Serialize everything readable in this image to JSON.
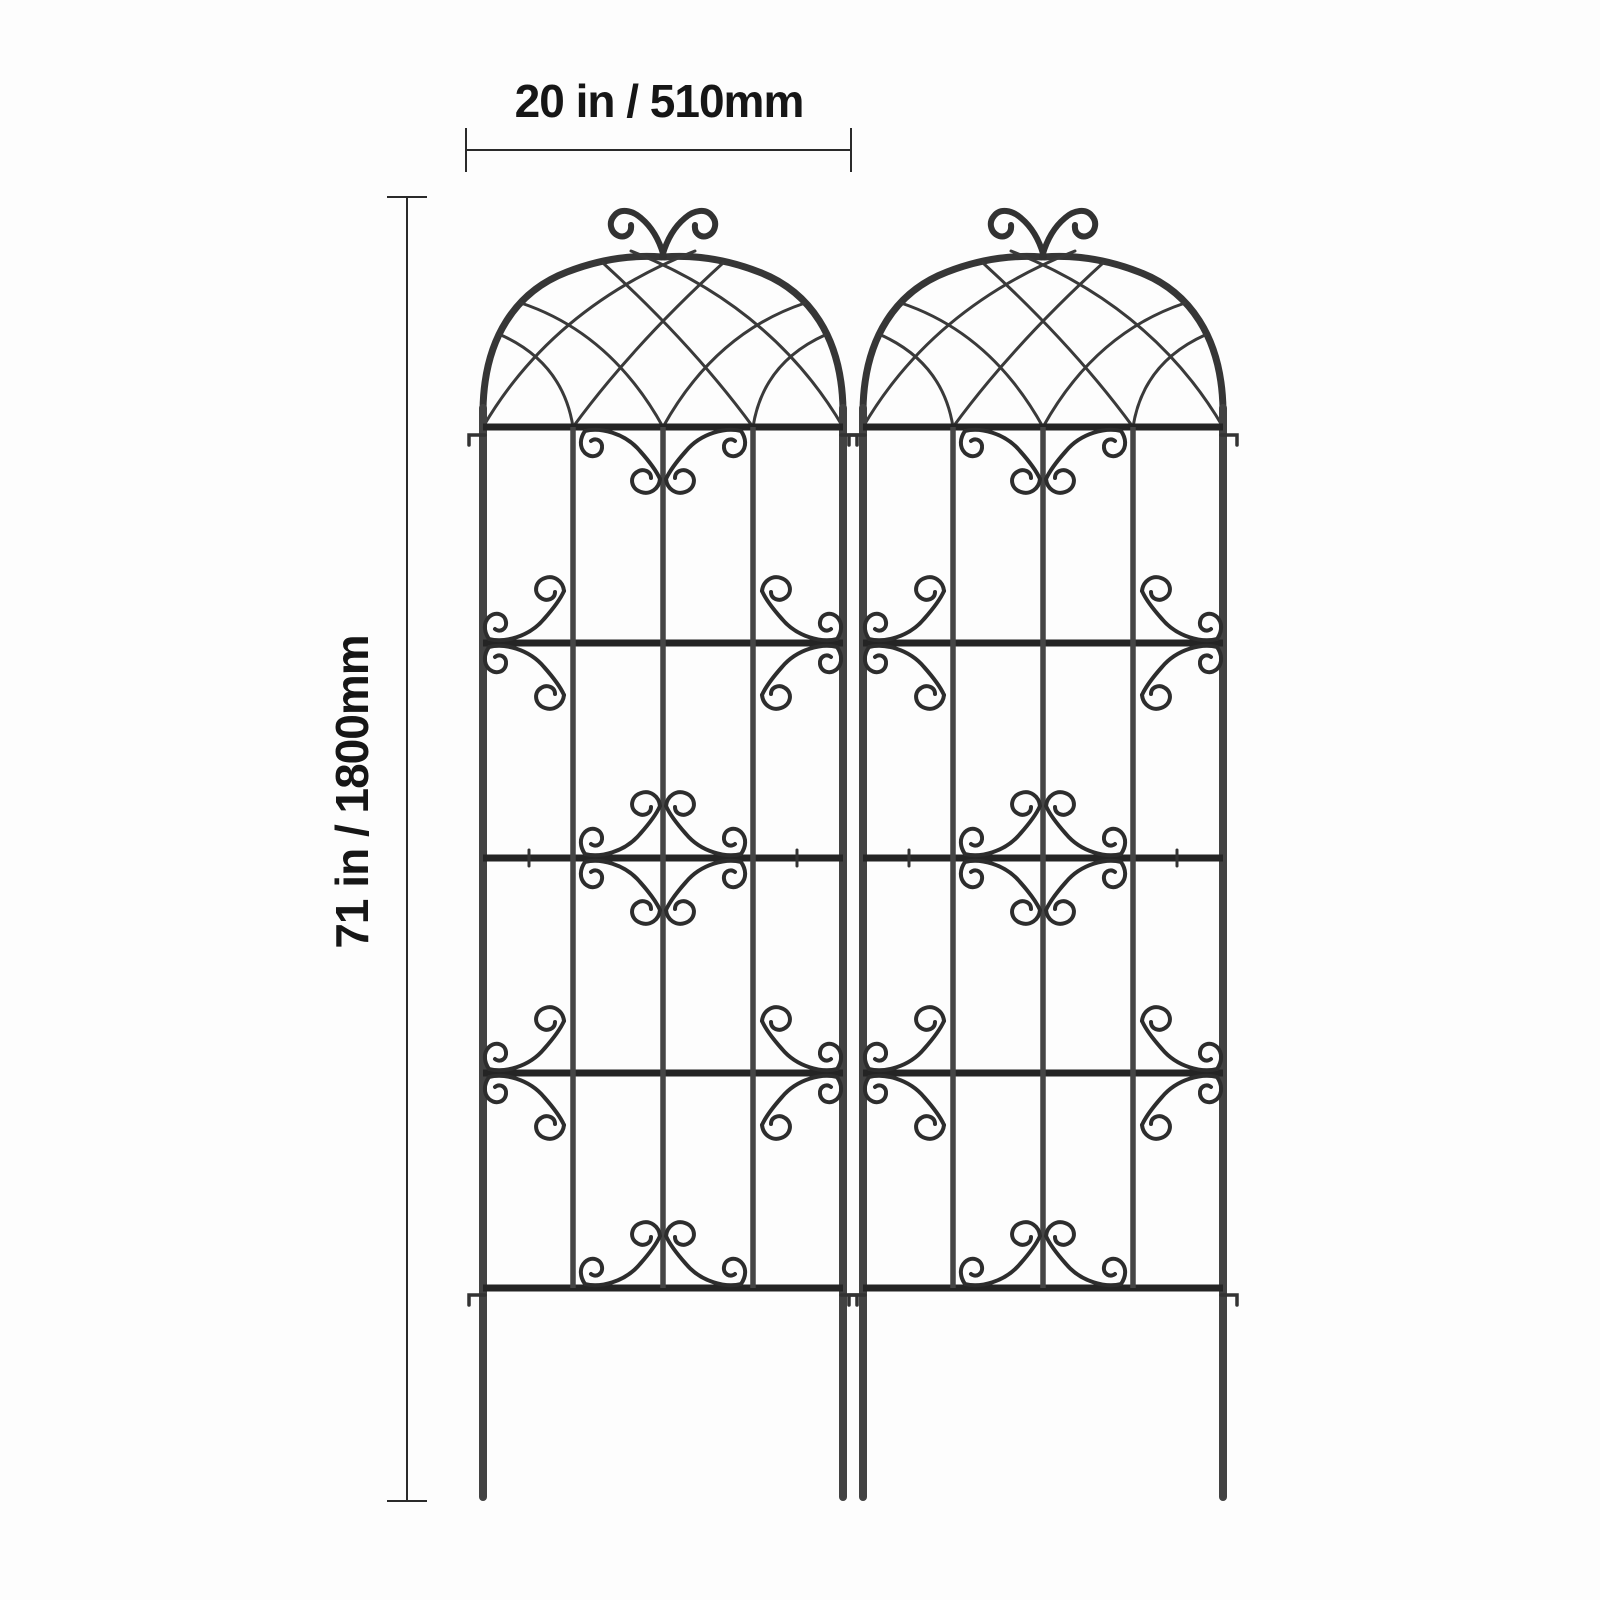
{
  "figure": {
    "subject": "two decorative metal garden trellis panels, dimension diagram",
    "panel_count": 2,
    "width_label": "20 in / 510mm",
    "height_label": "71 in / 1800mm"
  },
  "colors": {
    "background": "#fdfdfd",
    "metal_frame": "#363636",
    "metal_bar": "#242424",
    "dimension_line": "#2a2a2a",
    "label_text": "#161616"
  }
}
